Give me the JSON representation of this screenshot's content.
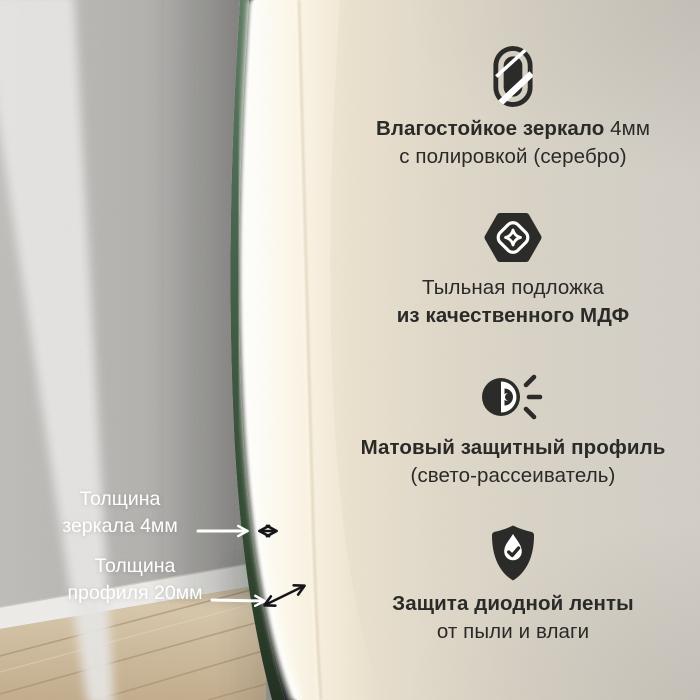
{
  "meta": {
    "language": "ru",
    "kind": "led-mirror-product-infographic"
  },
  "colors": {
    "text_dark": "#2a2a28",
    "text_light": "#ffffff",
    "mirror_edge_green": "#44604a",
    "profile_dark": "#14181a",
    "led_glow": "#fffef7",
    "wall_warm": "#e6dccb",
    "reflection_gray": "#b0aeab",
    "floor_wood": "#cfbc9e"
  },
  "measurements": [
    {
      "line1": "Толщина",
      "line2": "зеркала 4мм"
    },
    {
      "line1": "Толщина",
      "line2": "профиля 20мм"
    }
  ],
  "features": [
    {
      "icon": "mirror-icon",
      "line1_bold": "Влагостойкое зеркало",
      "line1_regular": " 4мм",
      "line2_bold": "",
      "line2_regular": "с полировкой (серебро)"
    },
    {
      "icon": "mdf-backing-icon",
      "line1_bold": "",
      "line1_regular": "Тыльная подложка",
      "line2_bold": "из качественного МДФ",
      "line2_regular": ""
    },
    {
      "icon": "light-diffuser-icon",
      "line1_bold": "Матовый защитный профиль",
      "line1_regular": "",
      "line2_bold": "",
      "line2_regular": "(свето-рассеиватель)"
    },
    {
      "icon": "shield-check-icon",
      "line1_bold": "Защита диодной ленты",
      "line1_regular": "",
      "line2_bold": "",
      "line2_regular": "от пыли и влаги"
    }
  ]
}
